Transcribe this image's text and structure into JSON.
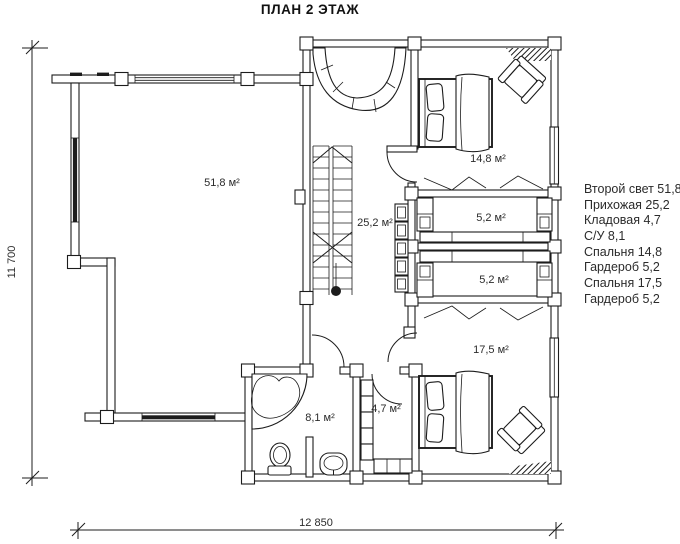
{
  "title": "ПЛАН 2 ЭТАЖ",
  "dimensions": {
    "vertical": "11 700",
    "horizontal": "12 850"
  },
  "rooms": {
    "second_light": "51,8 м²",
    "hallway": "25,2 м²",
    "bedroom_top": "14,8 м²",
    "wardrobe_top": "5,2 м²",
    "wardrobe_bottom": "5,2 м²",
    "bedroom_bottom": "17,5 м²",
    "bathroom": "8,1 м²",
    "storage": "4,7 м²"
  },
  "legend": {
    "items": [
      "Второй свет 51,8",
      "Прихожая 25,2",
      "Кладовая 4,7",
      "С/У 8,1",
      "Спальня 14,8",
      "Гардероб 5,2",
      "Спальня 17,5",
      "Гардероб 5,2"
    ]
  },
  "colors": {
    "line": "#1c1c1c",
    "background": "#ffffff"
  }
}
